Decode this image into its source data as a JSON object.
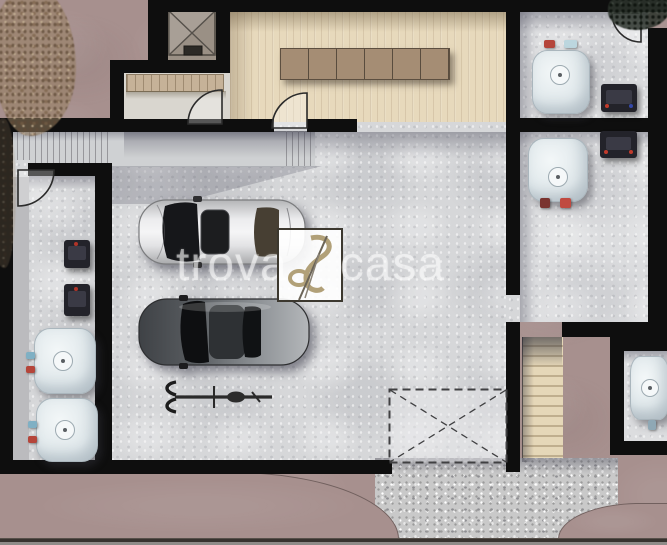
{
  "watermark": {
    "left_text": "trova",
    "right_text": "casa",
    "logo_name": "trovacasa-logo"
  },
  "palette": {
    "exterior_ground": "#a7908e",
    "wall": "#0e0e0e",
    "concrete_floor": "#d6d7d9",
    "wood_floor": "#e7d9bc",
    "wood_table": "#a58d74",
    "gravel_ramp": "#c9c9c9",
    "exterior_stairs": "#e5d7b8",
    "boiler_body": "#e9eef0",
    "electrical_panel": "#23232a",
    "car_silver": "#d9dadc",
    "car_dark": "#5a5e62",
    "watermark_text": "rgba(255,255,255,0.52)"
  },
  "inventory": {
    "cars": 2,
    "bicycles": 1,
    "water_heaters": 5,
    "electrical_panels": 4,
    "elevator_shafts": 1,
    "interior_staircases": 1,
    "exterior_staircases": 1,
    "door_swings": 4,
    "marked_garage_opening": 1,
    "trees": 2
  }
}
